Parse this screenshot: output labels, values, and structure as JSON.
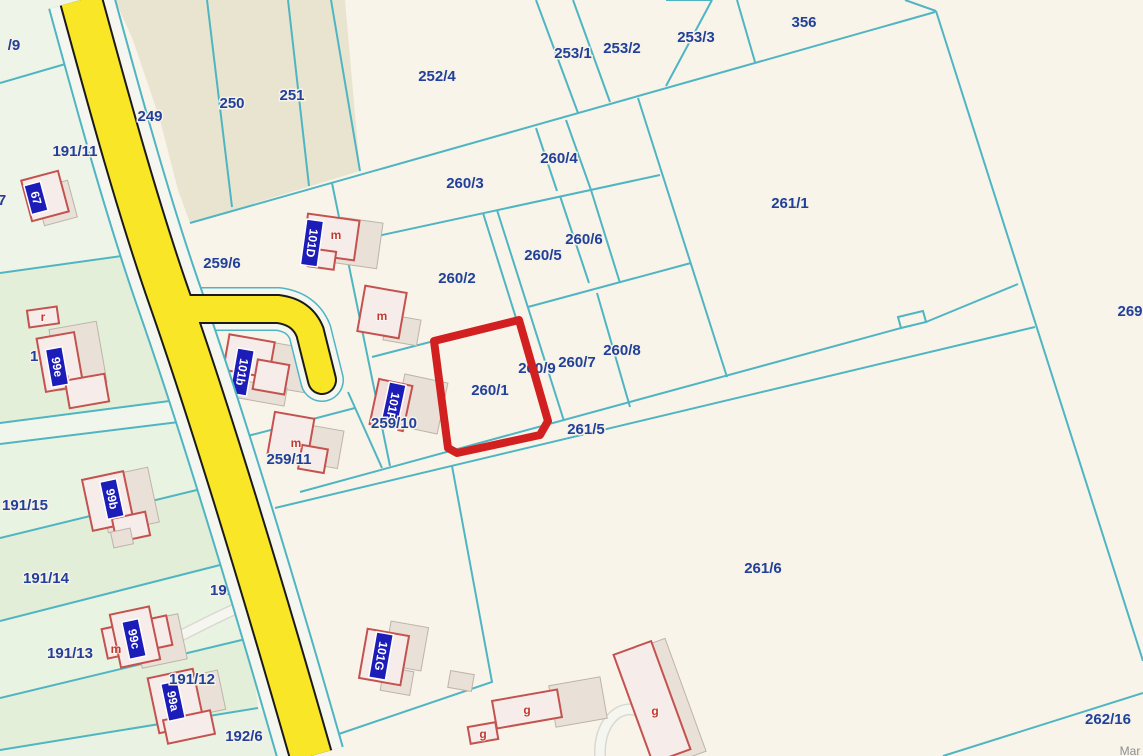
{
  "map": {
    "type": "cadastral-parcel-map",
    "attribution": "Mar",
    "highlight": {
      "parcel": "260/1",
      "color": "#d21f1f"
    },
    "colors": {
      "background": "#f8f4ea",
      "beige_strip": "#e9e4cf",
      "green_parcel_light": "#ecf5e7",
      "green_parcel_dark": "#e2eed8",
      "boundary_teal": "#4fb5c2",
      "road_yellow": "#f9e626",
      "road_edge_black": "#1a1a1a",
      "parcel_text": "#21409a",
      "building_outline_red": "#c4524e",
      "building_label_blue": "#1c1cb8",
      "letter_red": "#c23a2e",
      "highlight_red": "#d21f1f"
    },
    "parcels": {
      "p249": "249",
      "p250": "250",
      "p251": "251",
      "p252_4": "252/4",
      "p253_1": "253/1",
      "p253_2": "253/2",
      "p253_3": "253/3",
      "p356": "356",
      "p261_1": "261/1",
      "p269": "269",
      "p260_4": "260/4",
      "p260_3": "260/3",
      "p260_2": "260/2",
      "p260_5": "260/5",
      "p260_6": "260/6",
      "p260_7": "260/7",
      "p260_8": "260/8",
      "p260_9": "260/9",
      "p260_1": "260/1",
      "p261_5": "261/5",
      "p261_6": "261/6",
      "p262_16": "262/16",
      "p259_6": "259/6",
      "p259_8": "259/8",
      "p259_10": "259/10",
      "p259_11": "259/11",
      "p191_9": "/9",
      "p191_7": "/7",
      "p191_11": "191/11",
      "p191_17": "191/17",
      "p191_15": "191/15",
      "p191_14": "191/14",
      "p191_13": "191/13",
      "p191_12": "191/12",
      "p191_16": "191/16",
      "p192_6": "192/6",
      "p3": "3"
    },
    "buildings": {
      "b67": "67",
      "b99a": "99a",
      "b99b": "99b",
      "b99c": "99c",
      "b99e": "99e",
      "b101b": "101b",
      "b101d": "101D",
      "b101f": "101F",
      "b101g": "101G"
    },
    "letters": {
      "m": "m",
      "g": "g",
      "r": "r"
    }
  }
}
